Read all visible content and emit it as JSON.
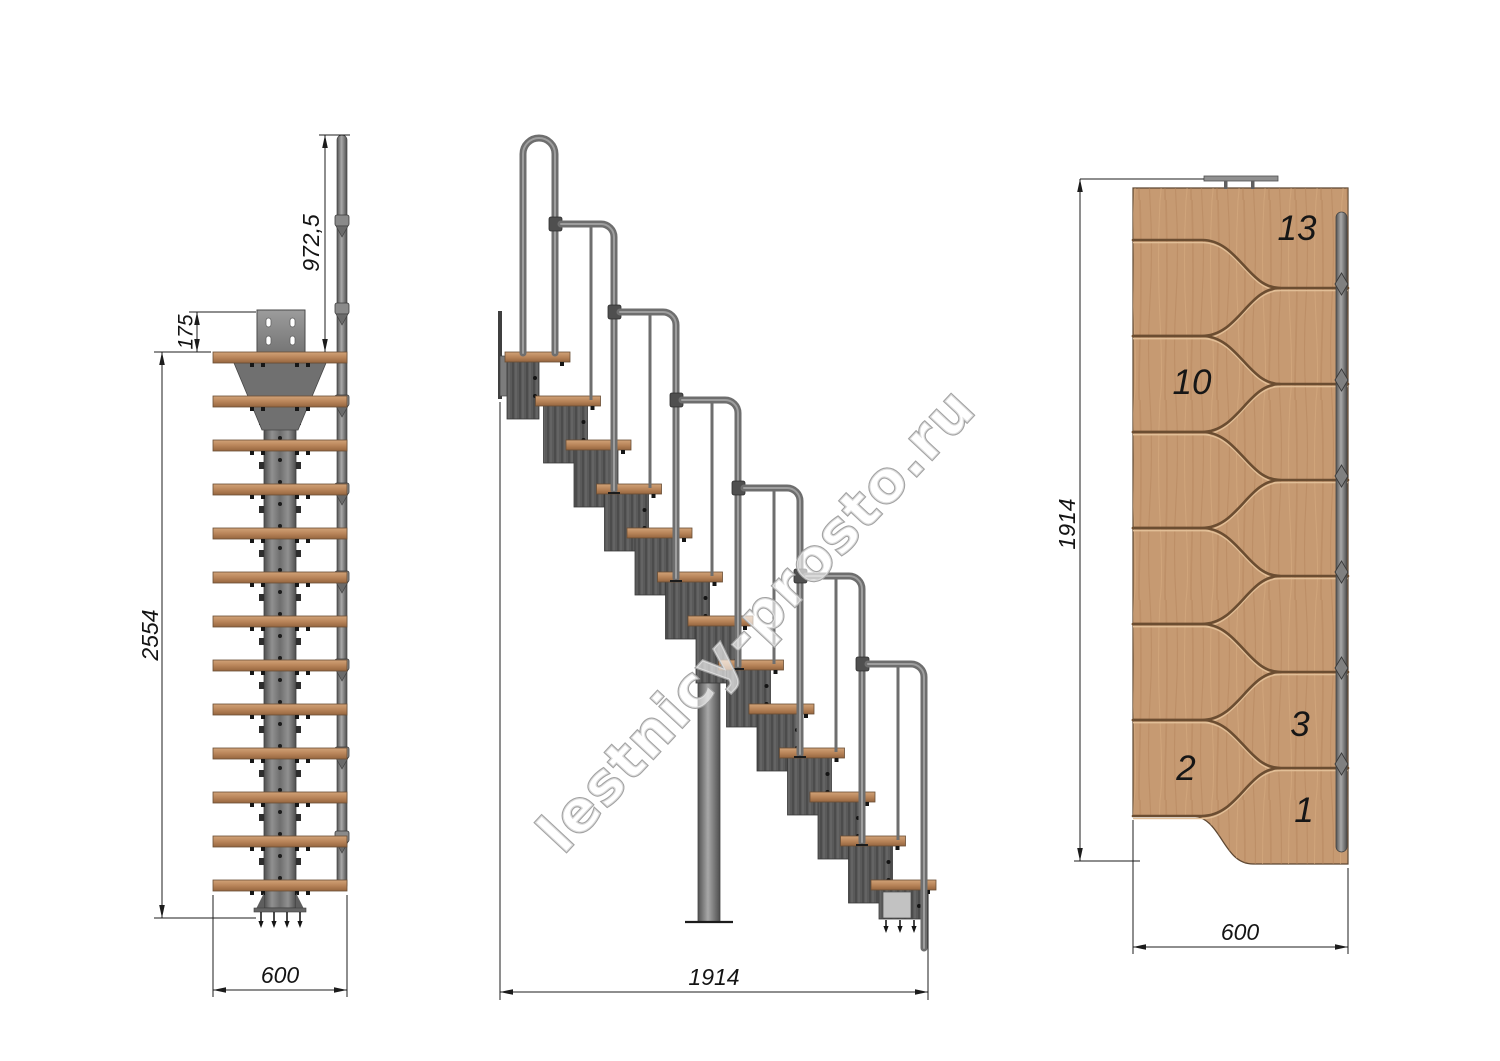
{
  "watermark": "lestnicy-prosto.ru",
  "front_view": {
    "dim_rail_height": "972,5",
    "dim_plate_offset": "175",
    "dim_total_height": "2554",
    "dim_width": "600",
    "tread_count": 13
  },
  "side_view": {
    "dim_length": "1914",
    "tread_count": 13
  },
  "plan_view": {
    "dim_length": "1914",
    "dim_width": "600",
    "tread_13": "13",
    "tread_10": "10",
    "tread_3": "3",
    "tread_2": "2",
    "tread_1": "1"
  },
  "colors": {
    "wood": "#c69a72",
    "wood_dark": "#95653f",
    "metal_tube": "#6e6e6e",
    "module_gray": "#575757",
    "plate_gray": "#8c8c8c",
    "line": "#1c1c1c",
    "watermark_outline": "#a2a2a2"
  }
}
